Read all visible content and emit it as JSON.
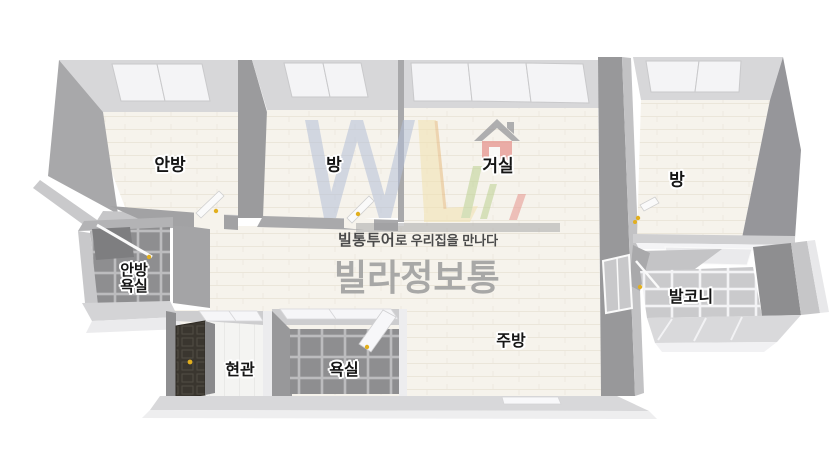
{
  "watermark": {
    "tagline_bold": "빌통투어",
    "tagline_rest": "로 우리집을 만나다",
    "brand": "빌라정보통",
    "logo_house_icon": "house-icon",
    "logo_monogram_icon": "w-monogram-icon"
  },
  "rooms": {
    "master_bedroom": {
      "label": "안방"
    },
    "bedroom2": {
      "label": "방"
    },
    "living_room": {
      "label": "거실"
    },
    "bedroom3": {
      "label": "방"
    },
    "master_bath": {
      "label_line1": "안방",
      "label_line2": "욕실"
    },
    "entrance": {
      "label": "현관"
    },
    "bathroom": {
      "label": "욕실"
    },
    "kitchen": {
      "label": "주방"
    },
    "balcony": {
      "label": "발코니"
    }
  },
  "colors": {
    "floor_cream": "#f6f3ec",
    "wall_light": "#d7d7d9",
    "wall_mid": "#b3b3b5",
    "wall_dark": "#98989a",
    "tile_dark": "#8e8e90",
    "tile_light": "#cacacc",
    "window_white": "#f4f4f6",
    "entry_door_dark": "#3a362f",
    "handle_yellow": "#e2af1e",
    "logo_blue": "#b3bfd8",
    "logo_yellow": "#f2e2b0",
    "logo_orange": "#e7bc80",
    "logo_green": "#bcd193",
    "logo_red": "#e6958f",
    "brand_grey": "#a4a4a4",
    "tagline_grey": "#4a4a4a"
  }
}
